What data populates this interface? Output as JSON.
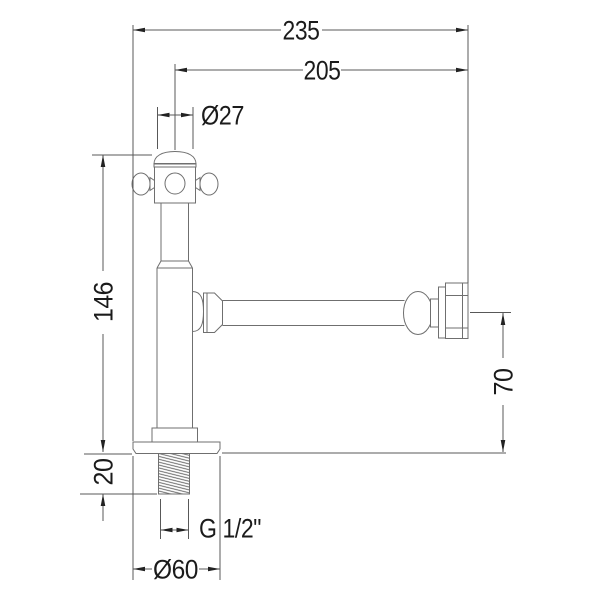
{
  "drawing": {
    "kind": "technical dimension drawing",
    "background": "#ffffff",
    "line_color": "#6f6f6f",
    "dimension_line_color": "#585858",
    "text_color": "#1b1b1b",
    "dimensions": {
      "overall_width": "235",
      "outlet_reach": "205",
      "body_diameter": "Ø27",
      "total_height": "146",
      "outlet_height": "70",
      "thread_length": "20",
      "thread_spec": "G 1/2\"",
      "base_diameter": "Ø60"
    }
  }
}
